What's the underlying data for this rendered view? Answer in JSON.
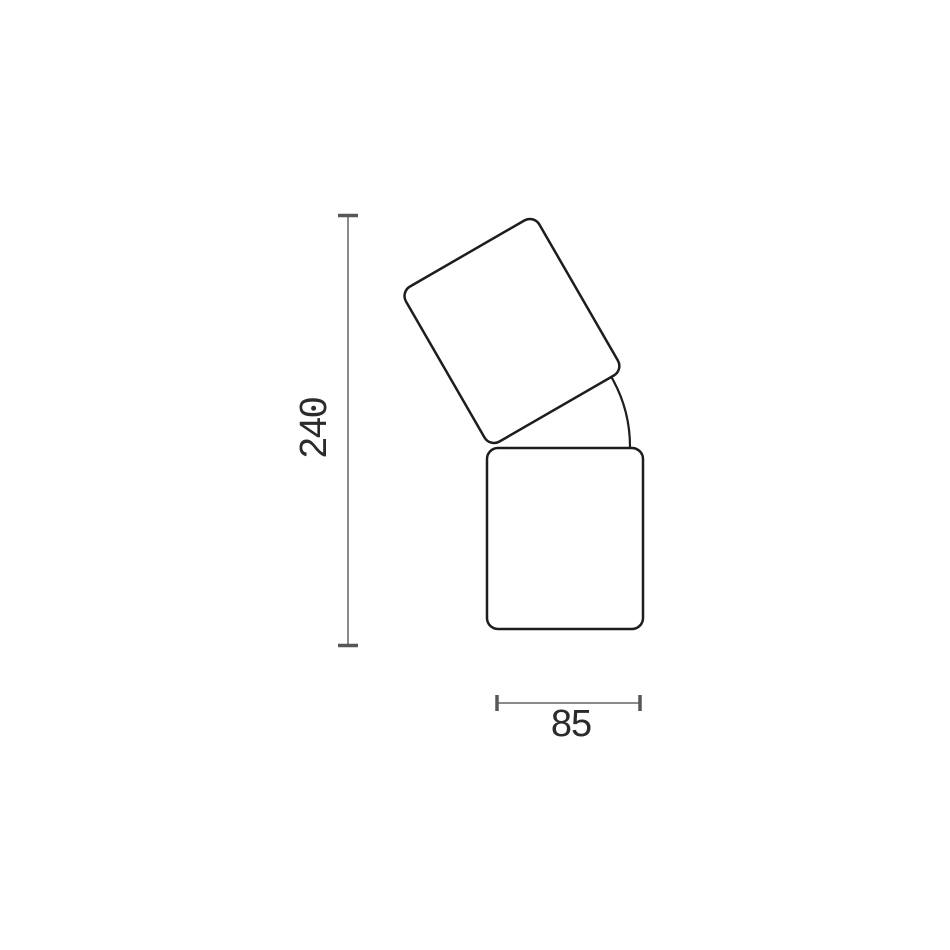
{
  "diagram": {
    "height_dimension": {
      "value": "240",
      "orientation": "vertical"
    },
    "width_dimension": {
      "value": "85",
      "orientation": "horizontal"
    },
    "colors": {
      "background": "#ffffff",
      "product_outline": "#1d1d1d",
      "dimension_line": "#8a8a8a",
      "dimension_tick": "#575757",
      "label_text": "#2b2b2b"
    }
  }
}
